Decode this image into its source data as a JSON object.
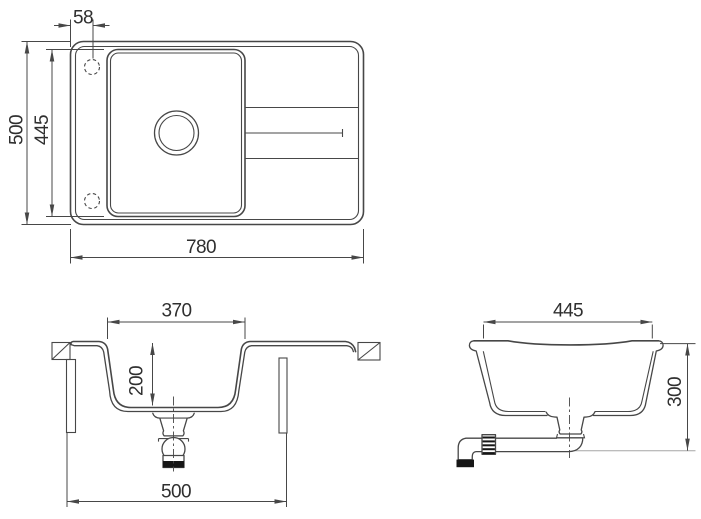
{
  "colors": {
    "line": "#474747",
    "text": "#2f2f2f",
    "light": "#a6a6a6",
    "blk": "#161616",
    "bg": "#ffffff"
  },
  "views": {
    "top": {
      "title": "top view",
      "dims": {
        "faucet_hole_offset": "58",
        "overall_width": "500",
        "cutout_width": "445",
        "overall_length": "780"
      }
    },
    "front": {
      "title": "front section",
      "dims": {
        "bowl_width": "370",
        "bowl_depth": "200",
        "cabinet_width": "500"
      }
    },
    "side": {
      "title": "side section",
      "dims": {
        "bowl_top_length": "445",
        "height_with_trap": "300"
      }
    }
  }
}
